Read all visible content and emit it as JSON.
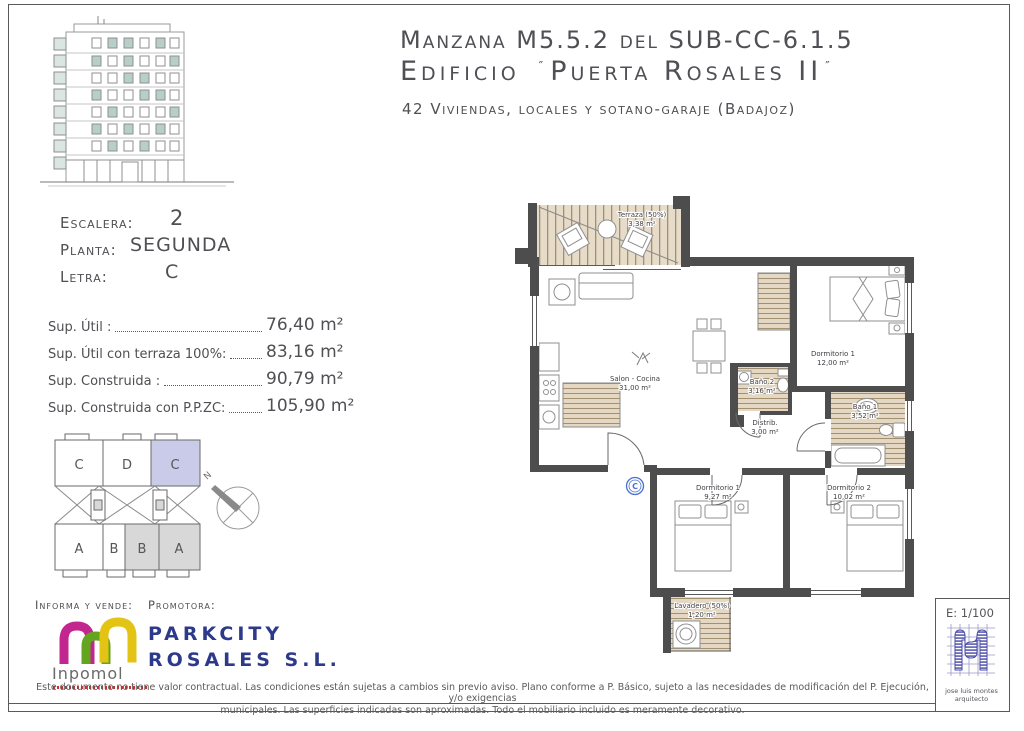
{
  "header": {
    "line1": "Manzana M5.5.2 del SUB-CC-6.1.5",
    "line2_prefix": "Edificio",
    "line2_name": "Puerta Rosales II",
    "quote": "″",
    "line3": "42 Viviendas, locales y sotano-garaje (Badajoz)"
  },
  "unit": {
    "escalera_label": "Escalera:",
    "escalera_value": "2",
    "planta_label": "Planta:",
    "planta_value": "SEGUNDA",
    "letra_label": "Letra:",
    "letra_value": "C"
  },
  "surfaces": {
    "rows": [
      {
        "label": "Sup. Útil :",
        "value": "76,40 m²"
      },
      {
        "label": "Sup. Útil con terraza 100%:",
        "value": "83,16 m²"
      },
      {
        "label": "Sup. Construida :",
        "value": "90,79 m²"
      },
      {
        "label": "Sup. Construida con P.P.ZC:",
        "value": "105,90 m²"
      }
    ]
  },
  "keyplan": {
    "top": [
      "C",
      "D",
      "C"
    ],
    "bottom": [
      "A",
      "B",
      "B",
      "A"
    ],
    "north": "N",
    "highlight_color": "#c9cbe9",
    "shaded_color": "#d8d8d8"
  },
  "floorplan": {
    "badge": "C",
    "rooms": {
      "terraza": {
        "name": "Terraza (50%)",
        "area": "3,38 m²"
      },
      "salon": {
        "name": "Salon - Cocina",
        "area": "31,00 m²"
      },
      "dorm1": {
        "name": "Dormitorio 1",
        "area": "12,00 m²"
      },
      "bano1": {
        "name": "Baño 1",
        "area": "3,52 m²"
      },
      "bano2": {
        "name": "Baño 2",
        "area": "3,16 m²"
      },
      "distrib": {
        "name": "Distrib.",
        "area": "3,00 m²"
      },
      "dorm3": {
        "name": "Dormitorio 1",
        "area": "9,27 m²"
      },
      "dorm2": {
        "name": "Dormitorio 2",
        "area": "10,02 m²"
      },
      "lavadero": {
        "name": "Lavadero (50%)",
        "area": "1,20 m²"
      }
    }
  },
  "scalebox": {
    "scale": "E: 1/100",
    "architect_line1": "jose luis montes",
    "architect_line2": "arquitecto"
  },
  "footer": {
    "informa": "Informa y vende:",
    "promotora": "Promotora:",
    "inpomol_text": "Inpomol",
    "parkcity_line1": "PARKCITY",
    "parkcity_line2": "ROSALES S.L.",
    "disclaimer_line1": "Este documento no tiene valor contractual. Las condiciones están sujetas a cambios sin previo aviso. Plano conforme a P. Básico, sujeto a las necesidades de modificación del P. Ejecución, y/o exigencias",
    "disclaimer_line2": "municipales. Las superficies indicadas son aproximadas. Todo el mobiliario incluido es meramente decorativo."
  },
  "colors": {
    "wall": "#4d4d4d",
    "parkcity_blue": "#2d3a8c",
    "badge_blue": "#4a6fd0",
    "logo_magenta": "#c2278f",
    "logo_green": "#64a51f",
    "logo_yellow": "#e3c414"
  }
}
